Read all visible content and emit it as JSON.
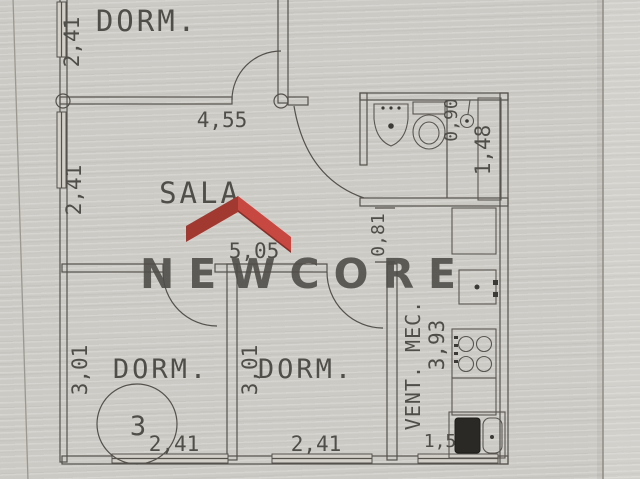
{
  "watermark": {
    "brand": "NEWCORE",
    "colors": {
      "roof_left": "#a23931",
      "roof_right": "#c74841",
      "roof_shadow": "#8d2d27",
      "text": "#f2f0eb"
    }
  },
  "plan": {
    "paper_color": "#cccac4",
    "line_color": "#55524d",
    "rooms": {
      "dorm_top": {
        "label": "DORM.",
        "dim_left": "2,41"
      },
      "sala": {
        "label": "SALA",
        "dim_top": "4,55",
        "dim_left": "2,41",
        "dim_bottom": "5,05"
      },
      "bathroom": {
        "dim_width": "0,90",
        "dim_height": "1,48"
      },
      "hall": {
        "dim_opening": "0,81"
      },
      "kitchen": {
        "label": "VENT. MEC.",
        "dim_height": "3,93",
        "dim_bottom": "1,5"
      },
      "dorm_left": {
        "label": "DORM.",
        "dim_left": "3,01",
        "dim_bottom": "2,41",
        "circle_number": "3"
      },
      "dorm_center": {
        "label": "DORM.",
        "dim_left": "3,01",
        "dim_bottom": "2,41"
      }
    }
  }
}
